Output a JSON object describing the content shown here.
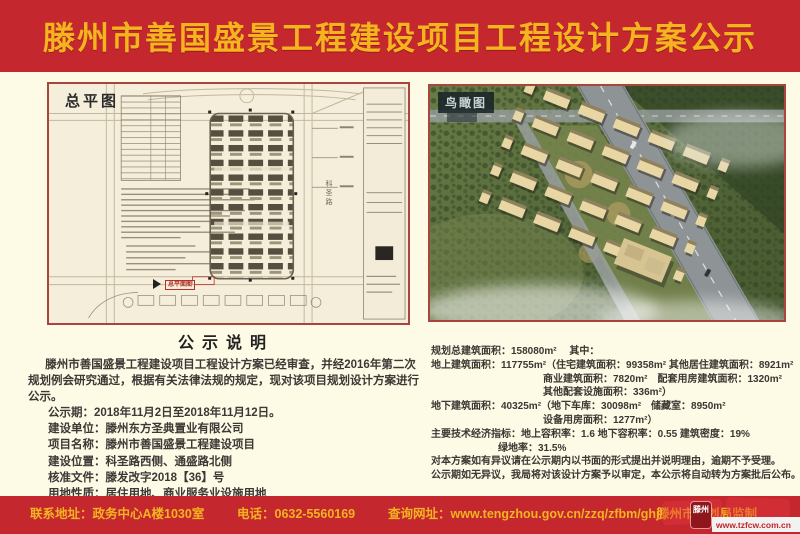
{
  "colors": {
    "band_red": "#c4272e",
    "gold": "#f3b41f",
    "cream": "#fdfae5",
    "panel_border": "#a8463e"
  },
  "header": {
    "title": "滕州市善国盛景工程建设项目工程设计方案公示"
  },
  "site_plan": {
    "label": "总平图",
    "stamp": "总平面图",
    "road_label": "科圣路"
  },
  "aerial": {
    "label": "鸟瞰图"
  },
  "notice": {
    "title": "公示说明",
    "paragraph": "滕州市善国盛景工程建设项目工程设计方案已经审查，并经2016年第二次规划例会研究通过，根据有关法律法规的规定，现对该项目规划设计方案进行公示。",
    "lines": [
      "公示期：2018年11月2日至2018年11月12日。",
      "建设单位：滕州东方圣典置业有限公司",
      "项目名称：滕州市善国盛景工程建设项目",
      "建设位置：科圣路西侧、通盛路北侧",
      "核准文件：滕发改字2018【36】号",
      "用地性质：居住用地、商业服务业设施用地"
    ]
  },
  "metrics": {
    "lines": [
      "规划总建筑面积：158080m²　 其中：",
      "地上建筑面积：117755m²（住宅建筑面积：99358m²  其他居住建筑面积：8921m²",
      "商业建筑面积：7820m²　配套用房建筑面积：1320m²",
      "其他配套设施面积：336m²）",
      "地下建筑面积：40325m²（地下车库：30098m²　储藏室：8950m²",
      "设备用房面积：1277m²）",
      "主要技术经济指标：地上容积率：1.6  地下容积率：0.55  建筑密度：19%",
      "绿地率：31.5%",
      "对本方案如有异议请在公示期内以书面的形式提出并说明理由，逾期不予受理。",
      "公示期如无异议，我局将对该设计方案予以审定，本公示将自动转为方案批后公布。"
    ]
  },
  "footer": {
    "contact": "联系地址：政务中心A楼1030室",
    "phone": "电话：0632-5560169",
    "website": "查询网址：www.tengzhou.gov.cn/zzq/zfbm/ghj/",
    "producer": "滕州市规划局监制",
    "watermark": {
      "logo": "滕州",
      "url": "www.tzfcw.com.cn"
    }
  }
}
